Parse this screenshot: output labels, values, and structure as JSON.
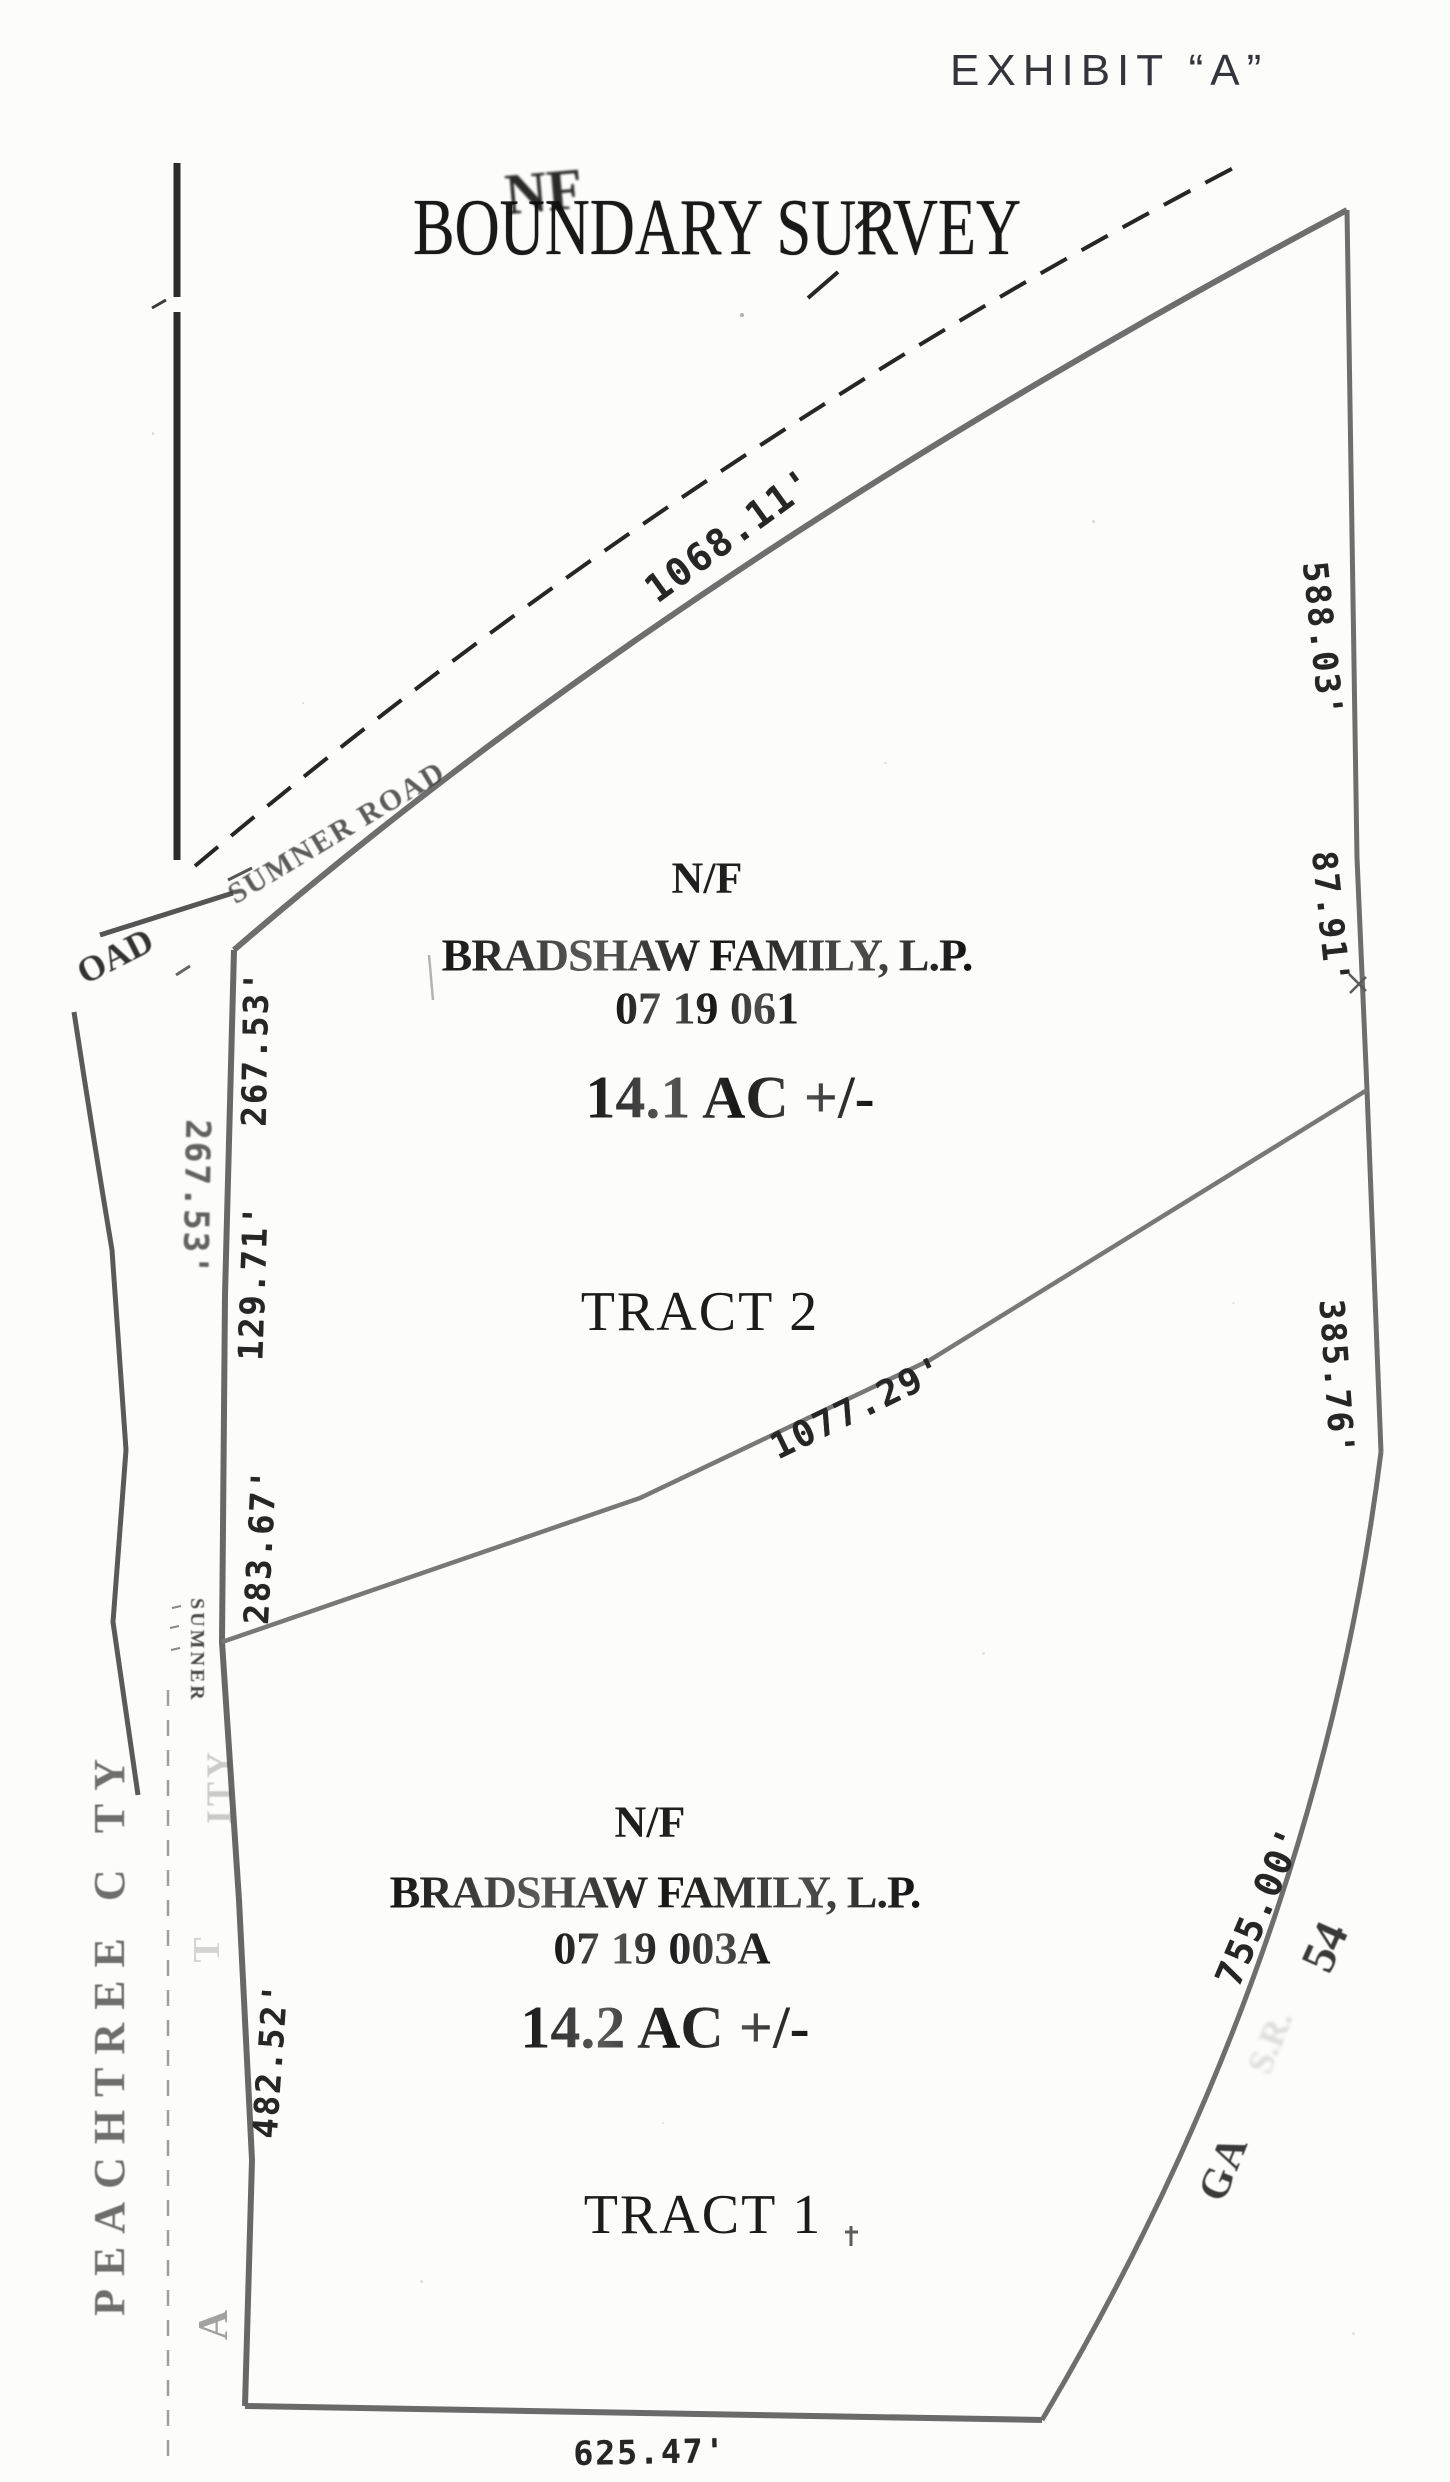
{
  "document": {
    "exhibit": "EXHIBIT “A”",
    "title": "BOUNDARY SURVEY",
    "overstamp": "NF"
  },
  "roads": {
    "sumner_road": "SUMNER ROAD",
    "sumner": "SUMNER",
    "road_fragment": "OAD",
    "peachtree_city": "PEACHTREE C TY",
    "ghost_city_suffix": "ITY",
    "ghost_t": "T",
    "ghost_a": "A",
    "ga_label": "GA",
    "route_54": "54",
    "route_smudge": "S.R."
  },
  "tract2": {
    "nf": "N/F",
    "owner": "BRADSHAW FAMILY, L.P.",
    "parcel_id": "07 19 061",
    "area": "14.1 AC +/-",
    "name": "TRACT 2"
  },
  "tract1": {
    "nf": "N/F",
    "owner": "BRADSHAW FAMILY, L.P.",
    "parcel_id": "07 19 003A",
    "area": "14.2 AC +/-",
    "name": "TRACT 1"
  },
  "measurements": {
    "north_boundary": "1068.11'",
    "east_upper": "588.03'",
    "east_jog": "87.91'",
    "east_lower": "385.76'",
    "division_line": "1077.29'",
    "ga54_frontage": "755.00'",
    "south_boundary": "625.47'",
    "west_seg1": "267.53'",
    "west_seg1_road": "267.53'",
    "west_seg2": "129.71'",
    "west_seg3": "283.67'",
    "west_seg4": "482.52'"
  },
  "colors": {
    "ink": "#1f1f1f",
    "boundary_gray": "#6e6e6e",
    "road_gray": "#4f4f4f",
    "paper": "#fcfcfa"
  }
}
